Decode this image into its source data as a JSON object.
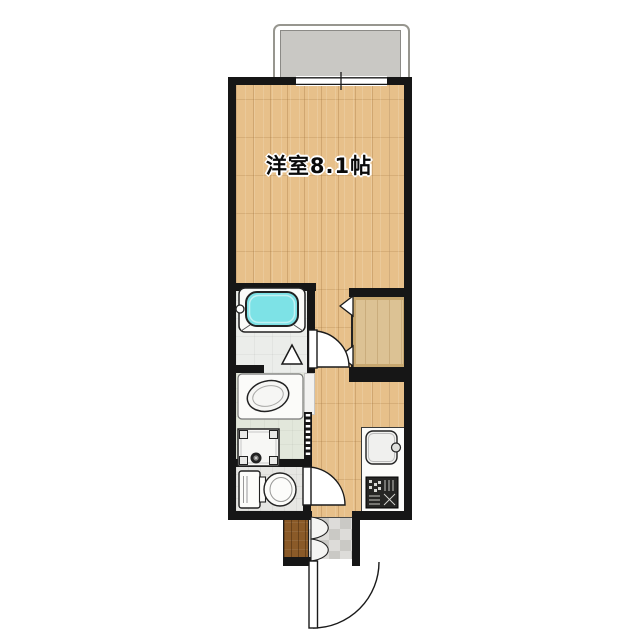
{
  "floorplan": {
    "main_room_label": "洋室8.1帖",
    "rooms_semantic": [
      "balcony",
      "western-room-8.1-mat",
      "bathroom",
      "closet",
      "hallway",
      "washroom",
      "toilet",
      "kitchen",
      "entrance"
    ],
    "fixtures_semantic": [
      "bathtub",
      "bathroom-folding-door",
      "closet-bifold-door",
      "washbasin",
      "washing-machine-pan",
      "accordion-door",
      "toilet",
      "kitchen-sink",
      "gas-stove",
      "sliding-window",
      "hinged-doors",
      "front-door"
    ],
    "colors": {
      "wall": "#161616",
      "wood_floor": "#e7c08a",
      "bathtub": "#7de2e6",
      "balcony_slab": "#c9c8c4",
      "entrance_step": "#8a5a28",
      "closet_fill": "#dcc294",
      "background": "#ffffff"
    }
  }
}
